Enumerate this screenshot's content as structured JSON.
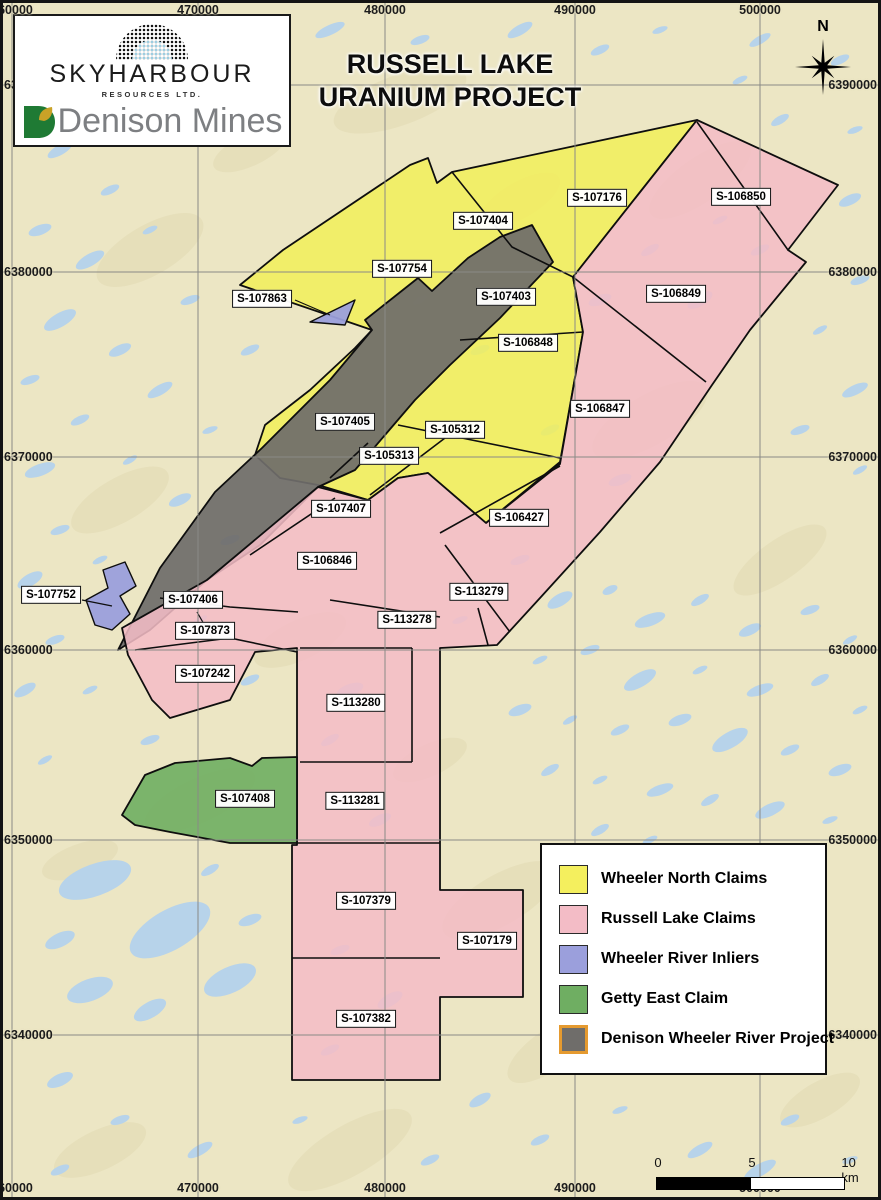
{
  "title": {
    "line1": "RUSSELL LAKE",
    "line2": "URANIUM PROJECT"
  },
  "logos": {
    "skyharbour_name": "SKYHARBOUR",
    "skyharbour_subtitle": "RESOURCES LTD.",
    "denison_name": "Denison Mines"
  },
  "compass": {
    "label": "N"
  },
  "grid": {
    "columns": [
      {
        "label": "460000",
        "x": 12
      },
      {
        "label": "470000",
        "x": 198
      },
      {
        "label": "480000",
        "x": 385
      },
      {
        "label": "490000",
        "x": 575
      },
      {
        "label": "500000",
        "x": 760
      }
    ],
    "rows": [
      {
        "label": "6390000",
        "y": 85
      },
      {
        "label": "6380000",
        "y": 272
      },
      {
        "label": "6370000",
        "y": 457
      },
      {
        "label": "6360000",
        "y": 650
      },
      {
        "label": "6350000",
        "y": 840
      },
      {
        "label": "6340000",
        "y": 1035
      }
    ]
  },
  "claims": [
    {
      "id": "S-107404",
      "type": "wheeler-north",
      "x": 483,
      "y": 221
    },
    {
      "id": "S-107176",
      "type": "wheeler-north",
      "x": 597,
      "y": 198
    },
    {
      "id": "S-106850",
      "type": "russell-lake",
      "x": 741,
      "y": 197
    },
    {
      "id": "S-107754",
      "type": "wheeler-north",
      "x": 402,
      "y": 269
    },
    {
      "id": "S-107863",
      "type": "wheeler-river-inlier",
      "x": 262,
      "y": 299
    },
    {
      "id": "S-107403",
      "type": "wheeler-north",
      "x": 506,
      "y": 297
    },
    {
      "id": "S-106849",
      "type": "russell-lake",
      "x": 676,
      "y": 294
    },
    {
      "id": "S-106848",
      "type": "wheeler-north",
      "x": 528,
      "y": 343
    },
    {
      "id": "S-106847",
      "type": "russell-lake",
      "x": 600,
      "y": 409
    },
    {
      "id": "S-107405",
      "type": "wheeler-north",
      "x": 345,
      "y": 422
    },
    {
      "id": "S-105312",
      "type": "wheeler-north",
      "x": 455,
      "y": 430
    },
    {
      "id": "S-105313",
      "type": "wheeler-north",
      "x": 389,
      "y": 456
    },
    {
      "id": "S-107407",
      "type": "russell-lake",
      "x": 341,
      "y": 509
    },
    {
      "id": "S-106427",
      "type": "russell-lake",
      "x": 519,
      "y": 518
    },
    {
      "id": "S-106846",
      "type": "russell-lake",
      "x": 327,
      "y": 561
    },
    {
      "id": "S-113279",
      "type": "russell-lake",
      "x": 479,
      "y": 592
    },
    {
      "id": "S-107752",
      "type": "wheeler-river-inlier",
      "x": 51,
      "y": 595
    },
    {
      "id": "S-107406",
      "type": "russell-lake",
      "x": 193,
      "y": 600
    },
    {
      "id": "S-113278",
      "type": "russell-lake",
      "x": 407,
      "y": 620
    },
    {
      "id": "S-107873",
      "type": "russell-lake",
      "x": 205,
      "y": 631
    },
    {
      "id": "S-107242",
      "type": "russell-lake",
      "x": 205,
      "y": 674
    },
    {
      "id": "S-113280",
      "type": "russell-lake",
      "x": 356,
      "y": 703
    },
    {
      "id": "S-107408",
      "type": "getty-east",
      "x": 245,
      "y": 799
    },
    {
      "id": "S-113281",
      "type": "russell-lake",
      "x": 355,
      "y": 801
    },
    {
      "id": "S-107379",
      "type": "russell-lake",
      "x": 366,
      "y": 901
    },
    {
      "id": "S-107179",
      "type": "russell-lake",
      "x": 487,
      "y": 941
    },
    {
      "id": "S-107382",
      "type": "russell-lake",
      "x": 366,
      "y": 1019
    }
  ],
  "legend": {
    "items": [
      {
        "label": "Wheeler North Claims",
        "color": "#f4ef5e",
        "border": "#2a2a2a"
      },
      {
        "label": "Russell Lake Claims",
        "color": "#f3bcc6",
        "border": "#2a2a2a"
      },
      {
        "label": "Wheeler River Inliers",
        "color": "#9b9fdc",
        "border": "#2a2a2a"
      },
      {
        "label": "Getty East Claim",
        "color": "#6fae62",
        "border": "#2a2a2a"
      },
      {
        "label": "Denison Wheeler River Project",
        "color": "#6f6d6a",
        "border": "#e59a2f"
      }
    ]
  },
  "scalebar": {
    "labels": [
      "0",
      "5",
      "10 km"
    ]
  },
  "colors": {
    "map_background": "#ece6c4",
    "lake": "#b7d3ea",
    "wheeler_north": "#f4ef5e",
    "russell_lake": "#f3bcc6",
    "wheeler_river_inlier": "#9b9fdc",
    "getty_east": "#6fae62",
    "denison_project": "#6f6d6a",
    "grid_line": "#8a8a86"
  }
}
